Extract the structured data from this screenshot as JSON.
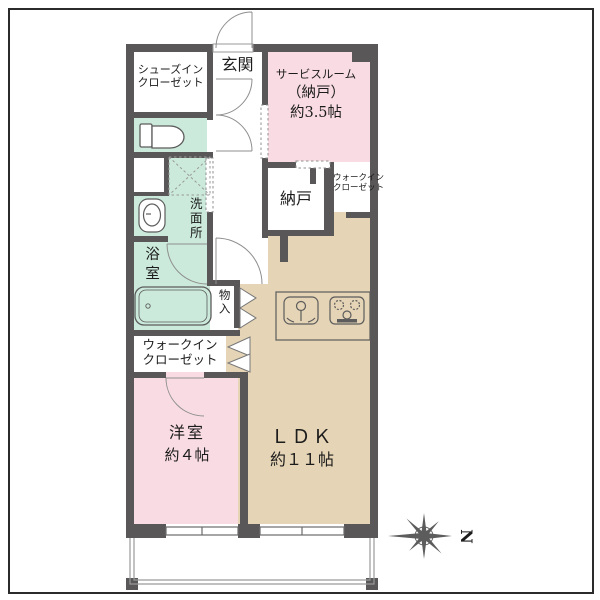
{
  "plan": {
    "entrance": {
      "label": "玄関"
    },
    "shoe_closet": {
      "line1": "シューズイン",
      "line2": "クローゼット"
    },
    "service_room": {
      "line1": "サービスルーム",
      "line2": "（納戸）",
      "line3": "約3.5帖"
    },
    "nando": {
      "label": "納戸"
    },
    "walkin_closet_upper": {
      "line1": "ウォークイン",
      "line2": "クローゼット"
    },
    "washroom": {
      "label": "洗面所"
    },
    "bathroom": {
      "label": "浴室"
    },
    "monoire": {
      "label": "物入"
    },
    "walkin_closet_lower": {
      "line1": "ウォークイン",
      "line2": "クローゼット"
    },
    "western_room": {
      "line1": "洋室",
      "line2": "約４帖"
    },
    "ldk": {
      "line1": "ＬＤＫ",
      "line2": "約１１帖"
    },
    "compass": {
      "north": "N"
    },
    "colors": {
      "wall": "#595757",
      "room_pink": "#f9dce3",
      "room_mint": "#cbeadb",
      "room_beige": "#e5d4b5",
      "floor_white": "#ffffff",
      "frame": "#2b2b2b"
    }
  }
}
